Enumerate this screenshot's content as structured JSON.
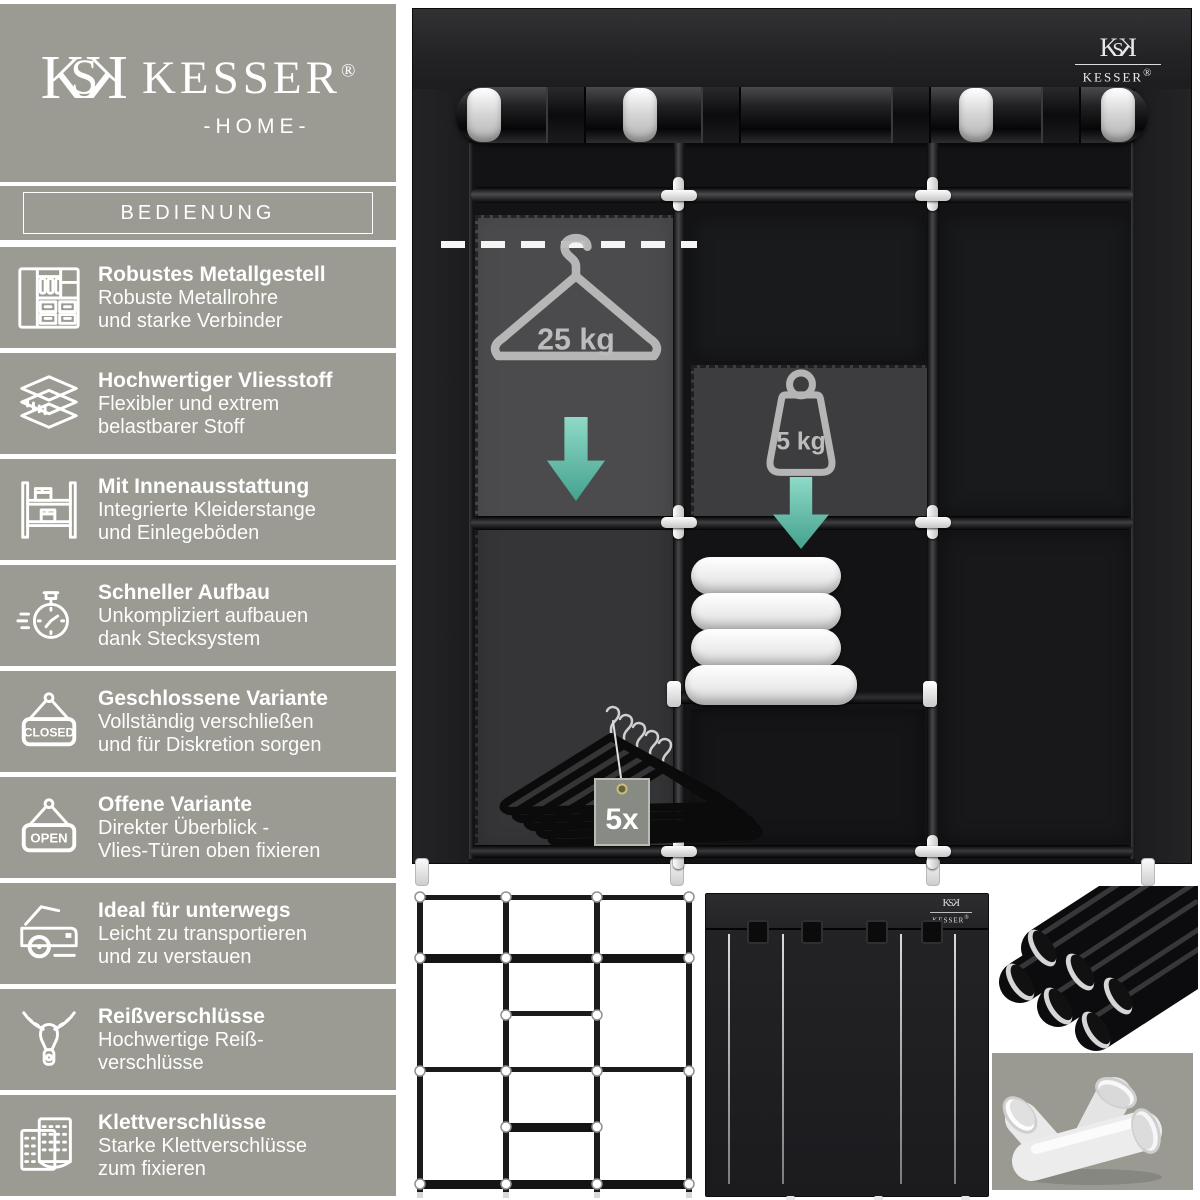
{
  "brand": {
    "name": "KESSER",
    "reg": "®",
    "home": "-HOME-",
    "monogram": {
      "k": "K",
      "s": "S"
    }
  },
  "sidebar": {
    "header": "BEDIENUNG",
    "bg_color": "#9b9b93",
    "items": [
      {
        "icon": "wardrobe-icon",
        "title": "Robustes Metallgestell",
        "lines": [
          "Robuste Metallrohre",
          "und starke Verbinder"
        ]
      },
      {
        "icon": "fabric-layers-icon",
        "title": "Hochwertiger Vliesstoff",
        "lines": [
          "Flexibler und extrem",
          "belastbarer Stoff"
        ]
      },
      {
        "icon": "shelf-rack-icon",
        "title": "Mit Innenausstattung",
        "lines": [
          "Integrierte Kleiderstange",
          "und Einlegeböden"
        ]
      },
      {
        "icon": "stopwatch-icon",
        "title": "Schneller Aufbau",
        "lines": [
          "Unkompliziert aufbauen",
          "dank Stecksystem"
        ]
      },
      {
        "icon": "closed-sign-icon",
        "title": "Geschlossene Variante",
        "lines": [
          "Vollständig verschließen",
          "und für Diskretion sorgen"
        ],
        "sign_label": "CLOSED"
      },
      {
        "icon": "open-sign-icon",
        "title": "Offene Variante",
        "lines": [
          "Direkter Überblick -",
          "Vlies-Türen oben fixieren"
        ],
        "sign_label": "OPEN"
      },
      {
        "icon": "car-trunk-icon",
        "title": "Ideal für unterwegs",
        "lines": [
          "Leicht zu transportieren",
          "und zu verstauen"
        ]
      },
      {
        "icon": "zipper-icon",
        "title": "Reißverschlüsse",
        "lines": [
          "Hochwertige Reiß-",
          "verschlüsse"
        ]
      },
      {
        "icon": "velcro-icon",
        "title": "Klettverschlüsse",
        "lines": [
          "Starke Klettverschlüsse",
          "zum fixieren"
        ]
      }
    ]
  },
  "product": {
    "annotations": {
      "hanger_capacity": "25 kg",
      "shelf_capacity": "5 kg",
      "hanger_count": "5x"
    },
    "colors": {
      "sidebar_gray": "#9b9b93",
      "accent_teal": "#5ebfab",
      "fabric_black": "#1c1c1e",
      "figure_panel_gray": "#9a9a93"
    }
  }
}
